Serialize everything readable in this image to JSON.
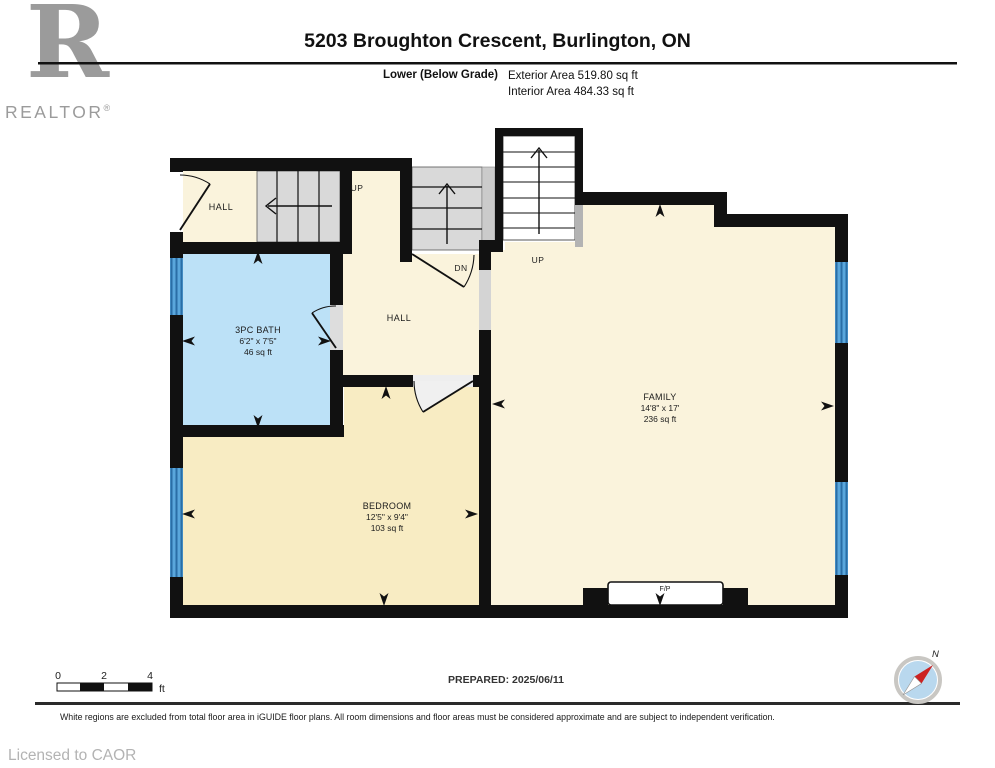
{
  "header": {
    "logo_letter": "R",
    "logo_brand": "REALTOR",
    "logo_reg": "®",
    "title": "5203 Broughton Crescent, Burlington, ON",
    "floor_label": "Lower (Below Grade)",
    "exterior_area": "Exterior Area 519.80 sq ft",
    "interior_area": "Interior Area 484.33 sq ft"
  },
  "plan": {
    "labels": {
      "hall_upper": "HALL",
      "hall_middle": "HALL",
      "up_left": "UP",
      "up_main": "UP",
      "down": "DN",
      "fireplace": "F/P"
    },
    "rooms": {
      "bath": {
        "name": "3PC BATH",
        "dims": "6'2\" x 7'5\"",
        "area": "46 sq ft"
      },
      "bedroom": {
        "name": "BEDROOM",
        "dims": "12'5\" x 9'4\"",
        "area": "103 sq ft"
      },
      "family": {
        "name": "FAMILY",
        "dims": "14'8\" x 17'",
        "area": "236 sq ft"
      }
    },
    "colors": {
      "wall": "#111111",
      "floor_cream": "#faf3dc",
      "floor_tan": "#f8ecc3",
      "floor_bath_blue": "#bce1f7",
      "stairs_gray": "#d9d9d9",
      "window_blue": "#5aa7dc",
      "window_stripe": "#2a6ea6"
    }
  },
  "footer": {
    "scale": {
      "tick0": "0",
      "tick2": "2",
      "tick4": "4",
      "unit": "ft"
    },
    "prepared": "PREPARED: 2025/06/11",
    "compass_north": "N",
    "disclaimer": "White regions are excluded from total floor area in iGUIDE floor plans. All room dimensions and floor areas must be considered approximate and are subject to independent verification.",
    "license": "Licensed to CAOR"
  }
}
